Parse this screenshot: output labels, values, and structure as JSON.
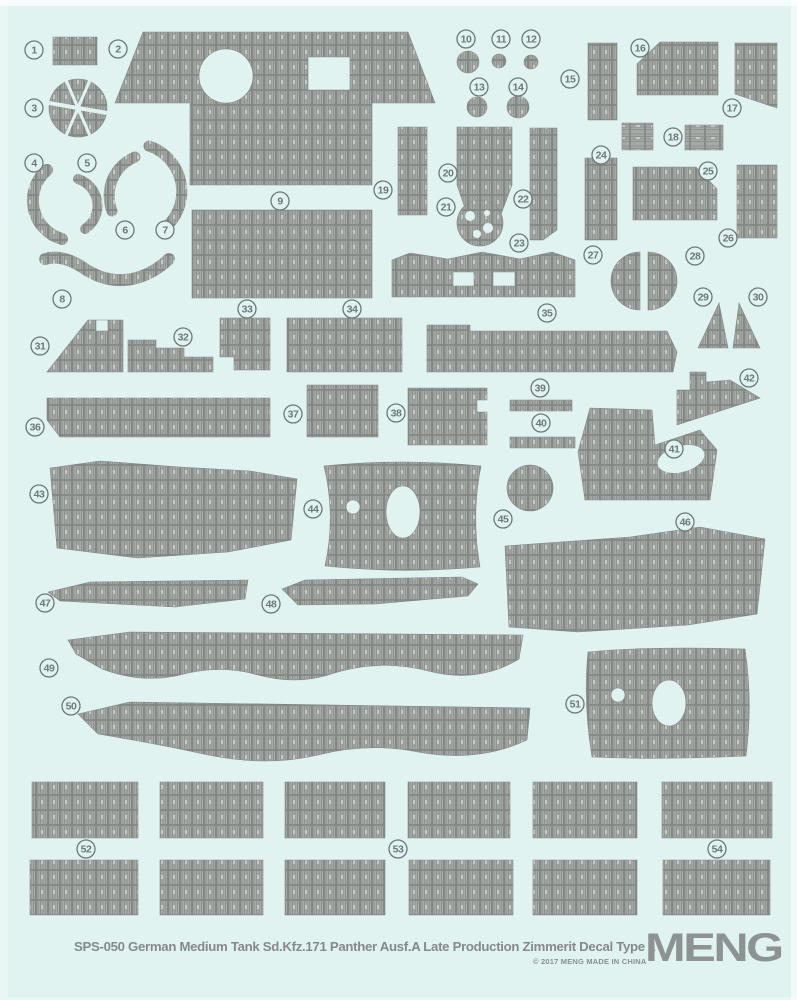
{
  "sheet": {
    "footer": {
      "title": "SPS-050 German Medium Tank Sd.Kfz.171 Panther Ausf.A Late Production Zimmerit Decal Type 1",
      "copyright": "© 2017 MENG  MADE IN CHINA",
      "brand": "MENG"
    },
    "colors": {
      "background": "#e0f3f0",
      "texture_base": "#a6aaa7",
      "texture_ridge": "#8f938f",
      "texture_grid": "#7d817e",
      "texture_light": "#c6cac7",
      "piece_outline": "#83878a",
      "label_color": "#6d787b",
      "title_color": "#85898b",
      "logo_color": "#8d9293"
    },
    "part_labels": [
      {
        "n": "1",
        "x": 34,
        "y": 50
      },
      {
        "n": "2",
        "x": 118,
        "y": 49
      },
      {
        "n": "3",
        "x": 34,
        "y": 108
      },
      {
        "n": "4",
        "x": 34,
        "y": 163
      },
      {
        "n": "5",
        "x": 87,
        "y": 163
      },
      {
        "n": "6",
        "x": 125,
        "y": 230
      },
      {
        "n": "7",
        "x": 165,
        "y": 230
      },
      {
        "n": "8",
        "x": 62,
        "y": 299
      },
      {
        "n": "9",
        "x": 280,
        "y": 201
      },
      {
        "n": "10",
        "x": 466,
        "y": 39
      },
      {
        "n": "11",
        "x": 501,
        "y": 39
      },
      {
        "n": "12",
        "x": 531,
        "y": 39
      },
      {
        "n": "13",
        "x": 479,
        "y": 87
      },
      {
        "n": "14",
        "x": 518,
        "y": 87
      },
      {
        "n": "15",
        "x": 570,
        "y": 79
      },
      {
        "n": "16",
        "x": 640,
        "y": 48
      },
      {
        "n": "17",
        "x": 732,
        "y": 108
      },
      {
        "n": "18",
        "x": 673,
        "y": 137
      },
      {
        "n": "19",
        "x": 383,
        "y": 190
      },
      {
        "n": "20",
        "x": 448,
        "y": 173
      },
      {
        "n": "21",
        "x": 446,
        "y": 207
      },
      {
        "n": "22",
        "x": 523,
        "y": 199
      },
      {
        "n": "23",
        "x": 519,
        "y": 243
      },
      {
        "n": "24",
        "x": 601,
        "y": 155
      },
      {
        "n": "25",
        "x": 708,
        "y": 171
      },
      {
        "n": "26",
        "x": 728,
        "y": 238
      },
      {
        "n": "27",
        "x": 593,
        "y": 255
      },
      {
        "n": "28",
        "x": 695,
        "y": 256
      },
      {
        "n": "29",
        "x": 703,
        "y": 297
      },
      {
        "n": "30",
        "x": 758,
        "y": 297
      },
      {
        "n": "31",
        "x": 40,
        "y": 346
      },
      {
        "n": "32",
        "x": 183,
        "y": 337
      },
      {
        "n": "33",
        "x": 247,
        "y": 309
      },
      {
        "n": "34",
        "x": 352,
        "y": 309
      },
      {
        "n": "35",
        "x": 547,
        "y": 313
      },
      {
        "n": "36",
        "x": 35,
        "y": 427
      },
      {
        "n": "37",
        "x": 293,
        "y": 414
      },
      {
        "n": "38",
        "x": 396,
        "y": 413
      },
      {
        "n": "39",
        "x": 540,
        "y": 388
      },
      {
        "n": "40",
        "x": 541,
        "y": 423
      },
      {
        "n": "41",
        "x": 674,
        "y": 449
      },
      {
        "n": "42",
        "x": 749,
        "y": 378
      },
      {
        "n": "43",
        "x": 39,
        "y": 494
      },
      {
        "n": "44",
        "x": 313,
        "y": 509
      },
      {
        "n": "45",
        "x": 503,
        "y": 519
      },
      {
        "n": "46",
        "x": 685,
        "y": 522
      },
      {
        "n": "47",
        "x": 45,
        "y": 603
      },
      {
        "n": "48",
        "x": 271,
        "y": 604
      },
      {
        "n": "49",
        "x": 49,
        "y": 668
      },
      {
        "n": "50",
        "x": 71,
        "y": 706
      },
      {
        "n": "51",
        "x": 575,
        "y": 704
      },
      {
        "n": "52",
        "x": 86,
        "y": 849
      },
      {
        "n": "53",
        "x": 398,
        "y": 849
      },
      {
        "n": "54",
        "x": 717,
        "y": 849
      }
    ],
    "pieces": [
      {
        "id": "1",
        "kind": "path",
        "d": "M53,37 H97 V65 H53 Z"
      },
      {
        "id": "2",
        "kind": "path",
        "d": "M143,32 H408 L435,103 H372 V185 H190 V103 H115 Z M199,76 a27,27 0 1 0 54,0 a27,27 0 1 0 -54,0 M308,57 H350 V90 H308 Z"
      },
      {
        "id": "3",
        "kind": "circle",
        "cx": 78,
        "cy": 108,
        "r": 29
      },
      {
        "id": "4",
        "kind": "arc",
        "w": 12,
        "d": "M47,170 A40,40 0 0 0 62,239"
      },
      {
        "id": "5",
        "kind": "arc",
        "w": 10,
        "d": "M78,179 A28,28 0 0 1 85,229"
      },
      {
        "id": "6",
        "kind": "arc",
        "w": 11,
        "d": "M135,157 A42,42 0 0 0 112,211"
      },
      {
        "id": "7",
        "kind": "arc",
        "w": 11,
        "d": "M149,146 A48,48 0 0 1 161,231"
      },
      {
        "id": "8",
        "kind": "arc",
        "w": 12,
        "d": "M45,259 Q62,254 82,267 Q106,284 132,279 Q152,275 169,259"
      },
      {
        "id": "9",
        "kind": "path",
        "d": "M192,210 H372 V298 H192 Z"
      },
      {
        "id": "10",
        "kind": "circle",
        "cx": 468,
        "cy": 62,
        "r": 11
      },
      {
        "id": "11",
        "kind": "circle",
        "cx": 499,
        "cy": 61,
        "r": 7
      },
      {
        "id": "12",
        "kind": "circle",
        "cx": 531,
        "cy": 62,
        "r": 7
      },
      {
        "id": "13",
        "kind": "circle",
        "cx": 477,
        "cy": 107,
        "r": 10
      },
      {
        "id": "14",
        "kind": "circle",
        "cx": 518,
        "cy": 107,
        "r": 11
      },
      {
        "id": "15",
        "kind": "path",
        "d": "M588,43 H617 V120 H588 Z"
      },
      {
        "id": "16",
        "kind": "path",
        "d": "M660,42 H718 V95 H637 V64 Z"
      },
      {
        "id": "17",
        "kind": "path",
        "d": "M735,43 H777 V108 L735,94 Z"
      },
      {
        "id": "18a",
        "kind": "path",
        "pattern": "ladder",
        "d": "M622,123 H653 V150 H622 Z"
      },
      {
        "id": "18b",
        "kind": "path",
        "pattern": "ladder",
        "d": "M685,125 H723 V150 H685 Z"
      },
      {
        "id": "19",
        "kind": "path",
        "d": "M398,127 H427 V215 H398 Z"
      },
      {
        "id": "20",
        "kind": "path",
        "d": "M457,127 H512 V185 L500,217 H468 L457,185 Z"
      },
      {
        "id": "21",
        "kind": "circle",
        "cx": 480,
        "cy": 223,
        "r": 23
      },
      {
        "id": "22",
        "kind": "path",
        "d": "M530,128 H557 V230 L543,240 H530 Z"
      },
      {
        "id": "23",
        "kind": "path",
        "d": "M392,260 L410,253 L448,259 L482,252 L520,259 L552,252 L575,260 V297 H392 Z M453,272 H474 V286 H453 Z M493,272 H515 V286 H493 Z"
      },
      {
        "id": "24",
        "kind": "path",
        "d": "M585,158 H617 V240 H585 Z"
      },
      {
        "id": "25",
        "kind": "path",
        "d": "M633,167 H696 L717,189 V220 H633 Z"
      },
      {
        "id": "26",
        "kind": "path",
        "d": "M737,165 H777 V238 H737 Z"
      },
      {
        "id": "27",
        "kind": "path",
        "d": "M640,252 A29,29 0 0 0 640,310 Z"
      },
      {
        "id": "28",
        "kind": "path",
        "d": "M648,252 A29,29 0 0 1 648,310 Z"
      },
      {
        "id": "29",
        "kind": "path",
        "d": "M698,348 L719,303 L728,348 Z"
      },
      {
        "id": "30",
        "kind": "path",
        "d": "M733,348 L739,303 L760,348 Z"
      },
      {
        "id": "31",
        "kind": "path",
        "d": "M88,320 H123 V372 H47 Z M96,320 H108 V331 H96 Z"
      },
      {
        "id": "32",
        "kind": "path",
        "d": "M128,340 H156 V348 H184 V357 H213 V372 H128 Z"
      },
      {
        "id": "33",
        "kind": "path",
        "d": "M220,318 H270 V370 H234 V357 H220 Z"
      },
      {
        "id": "34",
        "kind": "path",
        "d": "M287,318 H402 V372 H287 Z"
      },
      {
        "id": "35",
        "kind": "path",
        "d": "M427,325 H470 V331 H667 L677,352 L673,372 H427 Z"
      },
      {
        "id": "36",
        "kind": "path",
        "d": "M47,398 H270 V437 H60 L47,420 Z"
      },
      {
        "id": "37",
        "kind": "path",
        "d": "M307,385 H378 V437 H307 Z"
      },
      {
        "id": "38",
        "kind": "path",
        "d": "M408,388 H487 V400 H477 V412 H487 V445 H408 Z"
      },
      {
        "id": "39",
        "kind": "path",
        "d": "M510,400 H572 V411 H510 Z"
      },
      {
        "id": "40",
        "kind": "path",
        "d": "M510,437 H575 V448 H510 Z"
      },
      {
        "id": "41",
        "kind": "path",
        "d": "M590,408 L652,410 L655,445 L700,430 L717,450 L710,500 L585,500 L578,452 Z"
      },
      {
        "id": "42",
        "kind": "path",
        "d": "M690,372 H706 V382 L730,380 L760,398 L677,425 V390 L690,390 Z"
      },
      {
        "id": "43",
        "kind": "path",
        "d": "M50,468 L100,461 L180,467 L250,471 L297,479 L291,540 L228,552 L138,558 L57,548 Z"
      },
      {
        "id": "44",
        "kind": "path",
        "d": "M324,466 Q336,516 325,566 Q403,574 480,567 Q471,516 481,466 Q402,458 324,466 Z M386,512 a17,26 0 1 0 34,0 a17,26 0 1 0 -34,0 M346,507 a7,7 0 1 0 14,0 a7,7 0 1 0 -14,0"
      },
      {
        "id": "45",
        "kind": "circle",
        "cx": 530,
        "cy": 488,
        "r": 23
      },
      {
        "id": "46",
        "kind": "path",
        "d": "M505,546 L630,537 L700,527 L765,539 L757,614 L688,625 L578,632 L509,627 Z"
      },
      {
        "id": "47",
        "kind": "path",
        "d": "M48,592 L90,582 L248,580 L245,599 L175,607 L60,601 Z"
      },
      {
        "id": "48",
        "kind": "path",
        "d": "M282,589 L305,580 L462,577 L478,584 L468,596 L375,604 L298,605 Z"
      },
      {
        "id": "49",
        "kind": "path",
        "d": "M68,640 L130,632 L523,635 L519,659 Q478,684 428,671 Q378,658 328,675 Q295,685 258,675 Q220,664 180,675 Q142,684 102,669 L76,654 Z"
      },
      {
        "id": "50",
        "kind": "path",
        "d": "M78,714 L130,702 L530,708 L527,740 Q478,763 418,752 Q368,742 318,755 Q268,767 208,755 Q158,744 98,734 Z"
      },
      {
        "id": "51",
        "kind": "path",
        "d": "M588,652 Q650,646 745,649 Q753,702 746,756 Q660,760 592,757 Q583,703 588,652 Z M652,703 a17,23 0 1 0 34,0 a17,23 0 1 0 -34,0 M611,695 a7,7 0 1 0 14,0 a7,7 0 1 0 -14,0"
      },
      {
        "id": "52a",
        "kind": "path",
        "d": "M32,782 H138 V838 H32 Z"
      },
      {
        "id": "52b",
        "kind": "path",
        "d": "M160,782 H263 V838 H160 Z"
      },
      {
        "id": "52c",
        "kind": "path",
        "d": "M285,782 H385 V838 H285 Z"
      },
      {
        "id": "53a",
        "kind": "path",
        "d": "M408,782 H510 V838 H408 Z"
      },
      {
        "id": "53b",
        "kind": "path",
        "d": "M533,782 H637 V838 H533 Z"
      },
      {
        "id": "54a",
        "kind": "path",
        "d": "M662,782 H772 V838 H662 Z"
      },
      {
        "id": "52d",
        "kind": "path",
        "d": "M30,860 H138 V915 H30 Z"
      },
      {
        "id": "52e",
        "kind": "path",
        "d": "M160,860 H263 V915 H160 Z"
      },
      {
        "id": "53c",
        "kind": "path",
        "d": "M285,860 H385 V915 H285 Z"
      },
      {
        "id": "53d",
        "kind": "path",
        "d": "M409,860 H513 V915 H409 Z"
      },
      {
        "id": "54b",
        "kind": "path",
        "d": "M533,860 H637 V915 H533 Z"
      },
      {
        "id": "54c",
        "kind": "path",
        "d": "M663,860 H770 V915 H663 Z"
      }
    ],
    "white_overlays": [
      {
        "id": "seg-gap-1",
        "kind": "white-path",
        "w": 4,
        "d": "M49,103 L107,113"
      },
      {
        "id": "seg-gap-2",
        "kind": "white-path",
        "w": 3,
        "d": "M66,80 L90,136"
      },
      {
        "id": "seg-gap-3",
        "kind": "white-path",
        "w": 3,
        "d": "M90,80 L66,136"
      },
      {
        "id": "gear-hole-1",
        "kind": "white-circle",
        "cx": 470,
        "cy": 216,
        "r": 5
      },
      {
        "id": "gear-hole-2",
        "kind": "white-circle",
        "cx": 488,
        "cy": 228,
        "r": 5
      },
      {
        "id": "gear-hole-3",
        "kind": "white-circle",
        "cx": 477,
        "cy": 234,
        "r": 4
      },
      {
        "id": "gear-hole-4",
        "kind": "white-circle",
        "cx": 487,
        "cy": 213,
        "r": 3
      },
      {
        "id": "bite-41",
        "kind": "white-ellipse",
        "cx": 681,
        "cy": 459,
        "rx": 24,
        "ry": 13,
        "rot": -15
      }
    ]
  }
}
